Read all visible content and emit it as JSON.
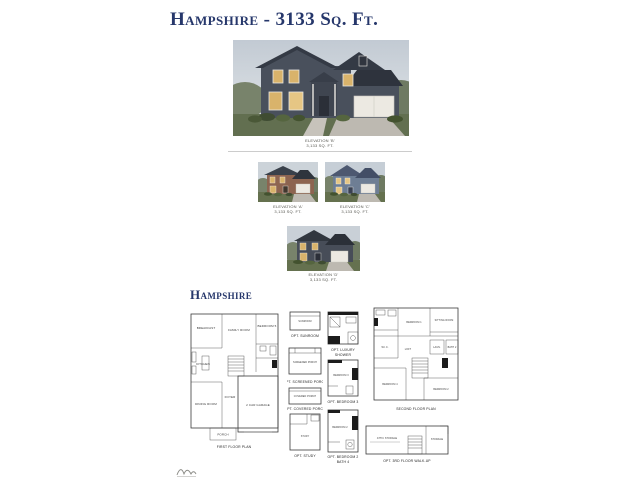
{
  "header": {
    "title": "Hampshire - 3133 Sq. Ft."
  },
  "section": {
    "title": "Hampshire"
  },
  "colors": {
    "title_navy": "#26376b",
    "house_siding_dark": "#49505c",
    "house_brick": "#8d6450",
    "house_blue": "#6e7e94",
    "grass": "#626f50",
    "window_lit": "#d9b36b"
  },
  "elevations": {
    "main": {
      "line1": "ELEVATION 'B'",
      "line2": "3,133 SQ. FT."
    },
    "a": {
      "line1": "ELEVATION 'A'",
      "line2": "3,133 SQ. FT."
    },
    "c": {
      "line1": "ELEVATION 'C'",
      "line2": "3,133 SQ. FT."
    },
    "d": {
      "line1": "ELEVATION 'D'",
      "line2": "3,133 SQ. FT."
    }
  },
  "first_floor": {
    "caption": "FIRST FLOOR PLAN",
    "rooms": {
      "breakfast": "BREAKFAST",
      "family": "FAMILY ROOM",
      "bedroom5": "BEDROOM 5",
      "kitchen": "KITCHEN",
      "dining": "DINING ROOM",
      "foyer": "FOYER",
      "garage": "2 CAR GARAGE",
      "porch": "PORCH"
    }
  },
  "second_floor": {
    "caption": "SECOND FLOOR PLAN",
    "rooms": {
      "bedroom1": "BEDROOM 1",
      "sitting": "SITTING ROOM",
      "wic": "W.I.C.",
      "loft": "LOFT",
      "laundry": "LAUN.",
      "bath2": "BATH 2",
      "bedroom4": "BEDROOM 4",
      "bedroom2": "BEDROOM 2"
    }
  },
  "options": {
    "sunroom": {
      "caption": "OPT. SUNROOM",
      "room": "SUNROOM"
    },
    "luxury_shower": {
      "caption_line1": "OPT. LUXURY",
      "caption_line2": "SHOWER"
    },
    "screened_porch": {
      "caption": "OPT. SCREENED PORCH",
      "room": "SCREENED PORCH"
    },
    "covered_porch": {
      "caption": "OPT. COVERED PORCH",
      "room": "COVERED PORCH"
    },
    "study": {
      "caption": "OPT. STUDY",
      "room": "STUDY"
    },
    "bedroom3": {
      "caption": "OPT. BEDROOM 3",
      "room": "BEDROOM 3"
    },
    "bedroom2_bath4": {
      "caption_line1": "OPT. BEDROOM 2",
      "caption_line2": "BATH 4",
      "room": "BEDROOM 2"
    },
    "walkup": {
      "caption": "OPT. 3RD FLOOR WALK-UP",
      "rooms": {
        "attic": "ATTIC STORAGE",
        "storage": "STORAGE"
      }
    }
  }
}
